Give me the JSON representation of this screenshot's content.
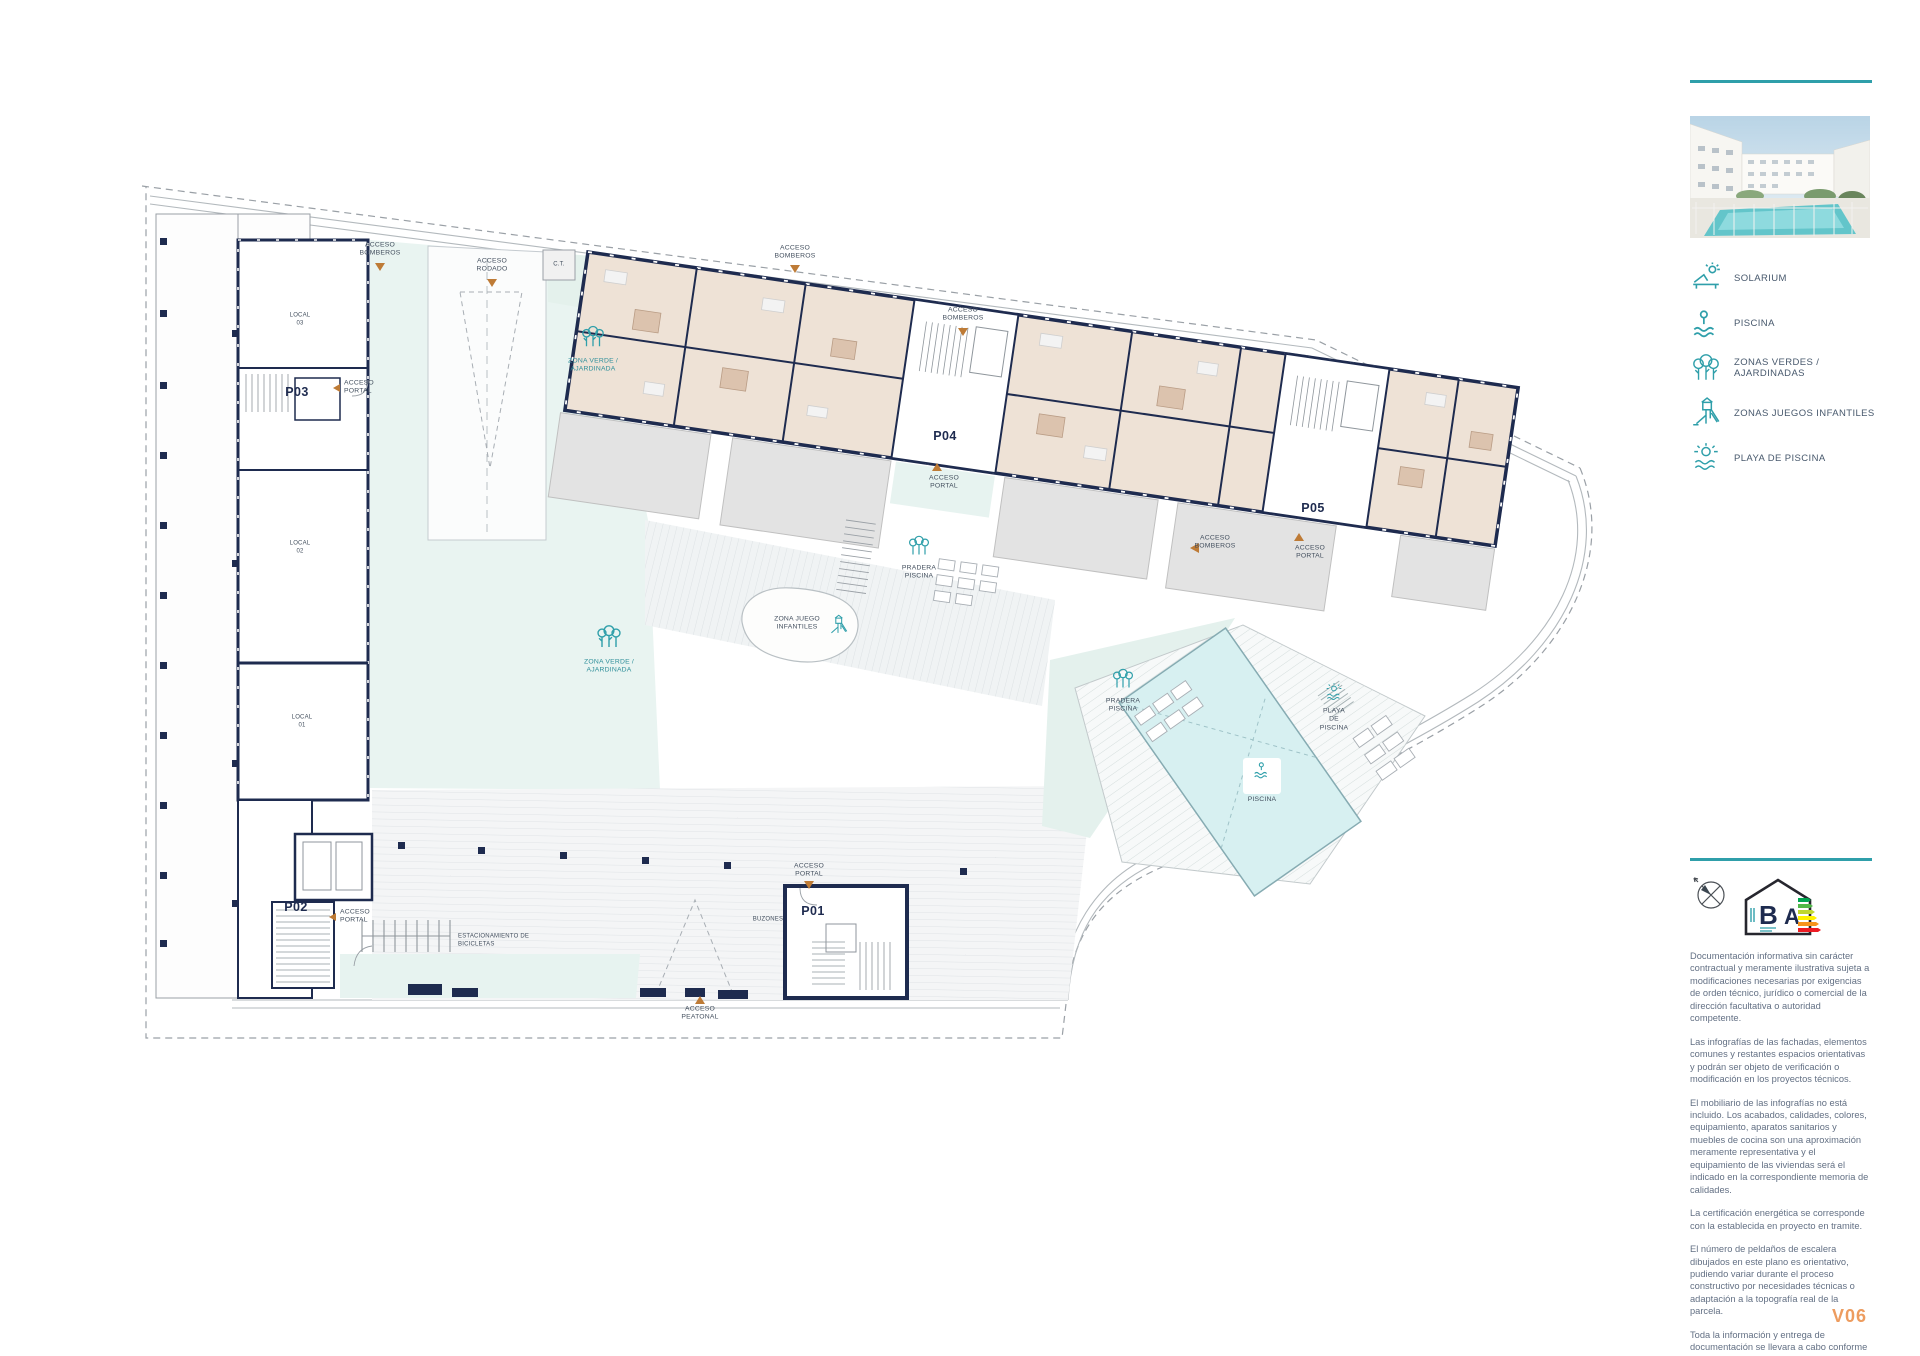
{
  "sidebar": {
    "legend": [
      {
        "icon": "solarium-icon",
        "label": "SOLARIUM"
      },
      {
        "icon": "piscina-icon",
        "label": "PISCINA"
      },
      {
        "icon": "zonas-verdes-icon",
        "label": "ZONAS VERDES / AJARDINADAS"
      },
      {
        "icon": "zonas-juegos-icon",
        "label": "ZONAS JUEGOS INFANTILES"
      },
      {
        "icon": "playa-piscina-icon",
        "label": "PLAYA DE PISCINA"
      }
    ],
    "energy": {
      "letter_b": "B",
      "letter_a": "A"
    },
    "disclaimer": [
      "Documentación informativa sin carácter contractual y meramente ilustrativa sujeta a modificaciones necesarias por exigencias de orden técnico, jurídico o comercial de la dirección facultativa o autoridad competente.",
      "Las infografías de las fachadas, elementos comunes y restantes espacios orientativas y podrán ser objeto de verificación o modificación en los proyectos técnicos.",
      "El mobiliario de las infografías no está incluido. Los acabados, calidades, colores, equipamiento, aparatos sanitarios y muebles de cocina son una aproximación meramente representativa y el equipamiento de las viviendas será el indicado en la correspondiente memoria de calidades.",
      "La certificación energética se corresponde con la establecida en proyecto en tramite.",
      "El número de peldaños de escalera dibujados en este plano es orientativo, pudiendo variar durante el proceso constructivo por necesidades técnicas o adaptación a la topografía real de la parcela.",
      "Toda la información y entrega de documentación se llevara a cabo conforme a lo dispuesto en el Real Decreto 515/1989 y demás normas que pudieran complementarlo ya sean de carácter estatal o autonómico."
    ],
    "version": "V06"
  },
  "plan": {
    "portals": {
      "p01": "P01",
      "p02": "P02",
      "p03": "P03",
      "p04": "P04",
      "p05": "P05"
    },
    "locals": {
      "l01": "LOCAL\n01",
      "l02": "LOCAL\n02",
      "l03": "LOCAL\n03"
    },
    "labels": {
      "ct": "C.T.",
      "acceso_bomberos": "ACCESO\nBOMBEROS",
      "acceso_rodado": "ACCESO\nRODADO",
      "acceso_portal": "ACCESO\nPORTAL",
      "acceso_peatonal": "ACCESO\nPEATONAL",
      "zona_verde": "ZONA VERDE /\nAJARDINADA",
      "zona_juego": "ZONA JUEGO\nINFANTILES",
      "pradera_piscina": "PRADERA\nPISCINA",
      "piscina": "PISCINA",
      "playa_piscina": "PLAYA\nDE\nPISCINA",
      "buzones": "BUZONES",
      "bicicletas": "ESTACIONAMIENTO DE\nBICICLETAS"
    }
  },
  "colors": {
    "accent_teal": "#2F9FAA",
    "wall_navy": "#1E2B4F",
    "access_orange": "#BE7B36",
    "version_orange": "#ED9C5F"
  }
}
